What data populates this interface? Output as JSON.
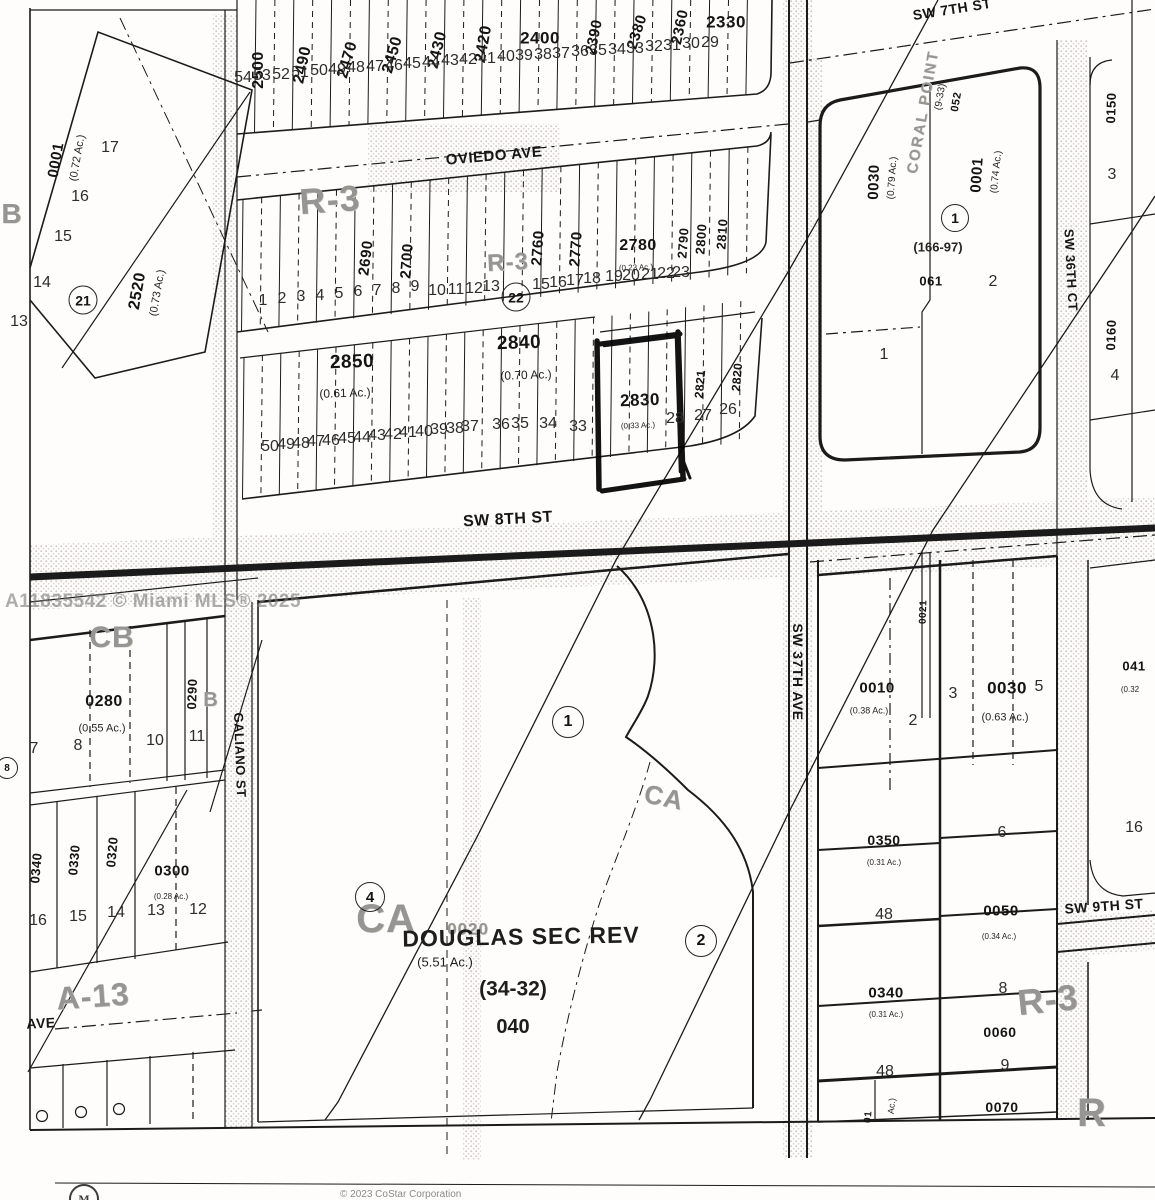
{
  "watermark": "A11835542 © Miami MLS® 2025",
  "footer": {
    "copyright": "© 2023 CoStar Corporation",
    "logo_letter": "M"
  },
  "colors": {
    "ink": "#1b1b1b",
    "zone_gray": "#979592",
    "paper": "#fefdfb",
    "highlight_marker": "#000000"
  },
  "highlighted_parcel": "2830",
  "subdivision": {
    "name": "DOUGLAS SEC REV",
    "plat": "(34-32)",
    "parcel": "040",
    "acreage": "(5.51 Ac.)"
  },
  "labels": {
    "streets": [
      {
        "t": "OVIEDO AVE",
        "x": 494,
        "y": 156,
        "s": 15,
        "r": -5,
        "n": "street-oviedo-ave"
      },
      {
        "t": "SW 8TH ST",
        "x": 508,
        "y": 520,
        "s": 16,
        "r": -3,
        "n": "street-sw-8th-st"
      },
      {
        "t": "SW 7TH ST",
        "x": 952,
        "y": 9,
        "s": 14,
        "r": -9,
        "n": "street-sw-7th-st"
      },
      {
        "t": "SW 37TH AVE",
        "x": 798,
        "y": 672,
        "s": 14,
        "r": 90,
        "n": "street-sw-37th-ave"
      },
      {
        "t": "SW 36TH CT",
        "x": 1071,
        "y": 270,
        "s": 13,
        "r": 87,
        "n": "street-sw-36th-ct"
      },
      {
        "t": "GALIANO ST",
        "x": 240,
        "y": 755,
        "s": 13,
        "r": 88,
        "n": "street-galiano-st"
      },
      {
        "t": "SW 9TH ST",
        "x": 1104,
        "y": 906,
        "s": 14,
        "r": -4,
        "n": "street-sw-9th-st"
      },
      {
        "t": "AVE",
        "x": 41,
        "y": 1023,
        "s": 14,
        "r": -3,
        "n": "street-ave"
      }
    ],
    "zones": [
      {
        "t": "R-3",
        "x": 330,
        "y": 200,
        "s": 36,
        "r": -4
      },
      {
        "t": "R-3",
        "x": 508,
        "y": 263,
        "s": 24,
        "r": -3
      },
      {
        "t": "B",
        "x": 12,
        "y": 214,
        "s": 28,
        "r": 0
      },
      {
        "t": "CB",
        "x": 112,
        "y": 638,
        "s": 30,
        "r": 0
      },
      {
        "t": "B",
        "x": 211,
        "y": 700,
        "s": 20,
        "r": 0
      },
      {
        "t": "A-13",
        "x": 93,
        "y": 996,
        "s": 32,
        "r": -4
      },
      {
        "t": "CA",
        "x": 664,
        "y": 797,
        "s": 26,
        "r": 12
      },
      {
        "t": "CA",
        "x": 386,
        "y": 919,
        "s": 40,
        "r": 0
      },
      {
        "t": "0020",
        "x": 468,
        "y": 929,
        "s": 17,
        "r": 0
      },
      {
        "t": "R-3",
        "x": 1048,
        "y": 1000,
        "s": 36,
        "r": -6
      },
      {
        "t": "R",
        "x": 1092,
        "y": 1113,
        "s": 40,
        "r": 0
      },
      {
        "t": "CORAL POINT",
        "x": 923,
        "y": 112,
        "s": 15,
        "r": -80,
        "ls": 2
      }
    ],
    "parcels": [
      {
        "t": "2500",
        "x": 259,
        "y": 70,
        "s": 16,
        "r": -90
      },
      {
        "t": "2490",
        "x": 303,
        "y": 65,
        "s": 16,
        "r": -78
      },
      {
        "t": "2470",
        "x": 348,
        "y": 60,
        "s": 16,
        "r": -74
      },
      {
        "t": "2450",
        "x": 393,
        "y": 55,
        "s": 16,
        "r": -74
      },
      {
        "t": "2430",
        "x": 438,
        "y": 50,
        "s": 16,
        "r": -76
      },
      {
        "t": "2420",
        "x": 484,
        "y": 44,
        "s": 16,
        "r": -80
      },
      {
        "t": "2400",
        "x": 540,
        "y": 38,
        "s": 17,
        "r": 0
      },
      {
        "t": "2390",
        "x": 594,
        "y": 37,
        "s": 15,
        "r": -78
      },
      {
        "t": "2380",
        "x": 637,
        "y": 32,
        "s": 15,
        "r": -72
      },
      {
        "t": "2360",
        "x": 680,
        "y": 27,
        "s": 15,
        "r": -78
      },
      {
        "t": "2330",
        "x": 726,
        "y": 22,
        "s": 17,
        "r": 0
      },
      {
        "t": "2690",
        "x": 366,
        "y": 258,
        "s": 15,
        "r": -83
      },
      {
        "t": "2700",
        "x": 407,
        "y": 261,
        "s": 15,
        "r": -86
      },
      {
        "t": "2760",
        "x": 538,
        "y": 248,
        "s": 15,
        "r": -86
      },
      {
        "t": "2770",
        "x": 576,
        "y": 249,
        "s": 15,
        "r": -86
      },
      {
        "t": "2780",
        "x": 638,
        "y": 246,
        "s": 16,
        "r": 0
      },
      {
        "t": "2790",
        "x": 683,
        "y": 243,
        "s": 13,
        "r": -86
      },
      {
        "t": "2800",
        "x": 701,
        "y": 239,
        "s": 13,
        "r": -86
      },
      {
        "t": "2810",
        "x": 722,
        "y": 234,
        "s": 13,
        "r": -86
      },
      {
        "t": "2850",
        "x": 352,
        "y": 362,
        "s": 19,
        "r": -2
      },
      {
        "t": "2840",
        "x": 519,
        "y": 343,
        "s": 19,
        "r": -2
      },
      {
        "t": "2830",
        "x": 640,
        "y": 400,
        "s": 17,
        "r": -2,
        "n": "parcel-number-2830-highlighted"
      },
      {
        "t": "2821",
        "x": 700,
        "y": 384,
        "s": 12,
        "r": -85
      },
      {
        "t": "2820",
        "x": 737,
        "y": 377,
        "s": 12,
        "r": -85
      },
      {
        "t": "2520",
        "x": 138,
        "y": 291,
        "s": 16,
        "r": -80
      },
      {
        "t": "0001",
        "x": 56,
        "y": 160,
        "s": 15,
        "r": -80
      },
      {
        "t": "0030",
        "x": 874,
        "y": 182,
        "s": 15,
        "r": -88
      },
      {
        "t": "052",
        "x": 957,
        "y": 102,
        "s": 11,
        "r": -80
      },
      {
        "t": "061",
        "x": 931,
        "y": 281,
        "s": 13,
        "r": 0
      },
      {
        "t": "0001",
        "x": 977,
        "y": 175,
        "s": 15,
        "r": -86
      },
      {
        "t": "0150",
        "x": 1111,
        "y": 108,
        "s": 13,
        "r": -88
      },
      {
        "t": "0160",
        "x": 1111,
        "y": 335,
        "s": 13,
        "r": -88
      },
      {
        "t": "0010",
        "x": 877,
        "y": 688,
        "s": 15,
        "r": 0
      },
      {
        "t": "0021",
        "x": 924,
        "y": 612,
        "s": 10,
        "r": -88
      },
      {
        "t": "0030",
        "x": 1007,
        "y": 688,
        "s": 17,
        "r": 0
      },
      {
        "t": "041",
        "x": 1134,
        "y": 666,
        "s": 13,
        "r": 0
      },
      {
        "t": "0350",
        "x": 884,
        "y": 840,
        "s": 14,
        "r": 0
      },
      {
        "t": "0050",
        "x": 1001,
        "y": 911,
        "s": 15,
        "r": 0
      },
      {
        "t": "0340",
        "x": 886,
        "y": 993,
        "s": 15,
        "r": 0
      },
      {
        "t": "0060",
        "x": 1000,
        "y": 1032,
        "s": 14,
        "r": 0
      },
      {
        "t": "0070",
        "x": 1002,
        "y": 1107,
        "s": 14,
        "r": 0
      },
      {
        "t": "0280",
        "x": 104,
        "y": 702,
        "s": 16,
        "r": 0
      },
      {
        "t": "0290",
        "x": 192,
        "y": 694,
        "s": 13,
        "r": -88
      },
      {
        "t": "0300",
        "x": 172,
        "y": 871,
        "s": 15,
        "r": 0
      },
      {
        "t": "0340",
        "x": 36,
        "y": 868,
        "s": 13,
        "r": -85
      },
      {
        "t": "0330",
        "x": 74,
        "y": 860,
        "s": 13,
        "r": -85
      },
      {
        "t": "0320",
        "x": 112,
        "y": 852,
        "s": 13,
        "r": -85
      },
      {
        "t": "01",
        "x": 869,
        "y": 1117,
        "s": 10,
        "r": -85
      }
    ],
    "acreages": [
      {
        "t": "(0.72 Ac.)",
        "x": 78,
        "y": 158,
        "s": 11,
        "r": -80
      },
      {
        "t": "(0.73 Ac.)",
        "x": 158,
        "y": 293,
        "s": 11,
        "r": -80
      },
      {
        "t": "(0.79 Ac.)",
        "x": 893,
        "y": 178,
        "s": 10,
        "r": -86
      },
      {
        "t": "(9-33)",
        "x": 941,
        "y": 97,
        "s": 10,
        "r": -80
      },
      {
        "t": "(0.74 Ac.)",
        "x": 997,
        "y": 172,
        "s": 10,
        "r": -84
      },
      {
        "t": "(166-97)",
        "x": 938,
        "y": 247,
        "s": 13,
        "r": 0,
        "w": 700
      },
      {
        "t": "(0.61 Ac.)",
        "x": 345,
        "y": 393,
        "s": 12,
        "r": -2
      },
      {
        "t": "(0.70 Ac.)",
        "x": 526,
        "y": 375,
        "s": 12,
        "r": -2
      },
      {
        "t": "(0.23 Ac.)",
        "x": 636,
        "y": 268,
        "s": 8,
        "r": -2
      },
      {
        "t": "(0.33 Ac.)",
        "x": 638,
        "y": 426,
        "s": 8,
        "r": -2
      },
      {
        "t": "(0.55 Ac.)",
        "x": 102,
        "y": 729,
        "s": 11,
        "r": 0
      },
      {
        "t": "(0.28 Ac.)",
        "x": 171,
        "y": 897,
        "s": 8,
        "r": 0
      },
      {
        "t": "(0.38 Ac.)",
        "x": 869,
        "y": 711,
        "s": 9,
        "r": 0
      },
      {
        "t": "(0.63 Ac.)",
        "x": 1005,
        "y": 718,
        "s": 11,
        "r": 0
      },
      {
        "t": "(0.32",
        "x": 1130,
        "y": 690,
        "s": 8,
        "r": 0
      },
      {
        "t": "(0.31 Ac.)",
        "x": 884,
        "y": 863,
        "s": 8,
        "r": 0
      },
      {
        "t": "(0.34 Ac.)",
        "x": 999,
        "y": 937,
        "s": 8,
        "r": 0
      },
      {
        "t": "(0.31 Ac.)",
        "x": 886,
        "y": 1015,
        "s": 8,
        "r": 0
      },
      {
        "t": "Ac.)",
        "x": 892,
        "y": 1106,
        "s": 9,
        "r": -85
      }
    ],
    "misc": [
      {
        "t": "DOUGLAS SEC REV",
        "x": 521,
        "y": 937,
        "s": 23,
        "r": -1,
        "w": 700,
        "ls": 1,
        "n": "subdivision-name"
      },
      {
        "t": "(5.51 Ac.)",
        "x": 445,
        "y": 962,
        "s": 13,
        "r": 0,
        "n": "subdivision-acreage"
      },
      {
        "t": "(34-32)",
        "x": 513,
        "y": 989,
        "s": 21,
        "r": 0,
        "w": 700,
        "n": "subdivision-plat"
      },
      {
        "t": "040",
        "x": 513,
        "y": 1027,
        "s": 20,
        "r": 0,
        "w": 700,
        "n": "subdivision-parcel"
      }
    ],
    "lots": [
      {
        "t": "54",
        "x": 243,
        "y": 78
      },
      {
        "t": "53",
        "x": 262,
        "y": 76
      },
      {
        "t": "52",
        "x": 281,
        "y": 75
      },
      {
        "t": "51",
        "x": 300,
        "y": 73
      },
      {
        "t": "50",
        "x": 319,
        "y": 71
      },
      {
        "t": "49",
        "x": 337,
        "y": 70
      },
      {
        "t": "48",
        "x": 356,
        "y": 68
      },
      {
        "t": "47",
        "x": 375,
        "y": 67
      },
      {
        "t": "46",
        "x": 394,
        "y": 66
      },
      {
        "t": "45",
        "x": 412,
        "y": 64
      },
      {
        "t": "44",
        "x": 431,
        "y": 63
      },
      {
        "t": "43",
        "x": 450,
        "y": 61
      },
      {
        "t": "42",
        "x": 468,
        "y": 60
      },
      {
        "t": "41",
        "x": 487,
        "y": 59
      },
      {
        "t": "40",
        "x": 506,
        "y": 57
      },
      {
        "t": "39",
        "x": 524,
        "y": 56
      },
      {
        "t": "38",
        "x": 543,
        "y": 55
      },
      {
        "t": "37",
        "x": 561,
        "y": 54
      },
      {
        "t": "36",
        "x": 580,
        "y": 52
      },
      {
        "t": "35",
        "x": 598,
        "y": 51
      },
      {
        "t": "34",
        "x": 617,
        "y": 50
      },
      {
        "t": "33",
        "x": 635,
        "y": 49
      },
      {
        "t": "32",
        "x": 654,
        "y": 47
      },
      {
        "t": "31",
        "x": 672,
        "y": 46
      },
      {
        "t": "30",
        "x": 691,
        "y": 44
      },
      {
        "t": "29",
        "x": 710,
        "y": 43
      },
      {
        "t": "1",
        "x": 263,
        "y": 301
      },
      {
        "t": "2",
        "x": 282,
        "y": 299
      },
      {
        "t": "3",
        "x": 301,
        "y": 297
      },
      {
        "t": "4",
        "x": 320,
        "y": 296
      },
      {
        "t": "5",
        "x": 339,
        "y": 294
      },
      {
        "t": "6",
        "x": 358,
        "y": 292
      },
      {
        "t": "7",
        "x": 377,
        "y": 291
      },
      {
        "t": "8",
        "x": 396,
        "y": 289
      },
      {
        "t": "9",
        "x": 415,
        "y": 287
      },
      {
        "t": "10",
        "x": 437,
        "y": 291
      },
      {
        "t": "11",
        "x": 456,
        "y": 290
      },
      {
        "t": "12",
        "x": 474,
        "y": 289
      },
      {
        "t": "13",
        "x": 491,
        "y": 287
      },
      {
        "t": "15",
        "x": 541,
        "y": 285
      },
      {
        "t": "16",
        "x": 558,
        "y": 283
      },
      {
        "t": "17",
        "x": 575,
        "y": 281
      },
      {
        "t": "18",
        "x": 592,
        "y": 279
      },
      {
        "t": "19",
        "x": 614,
        "y": 277
      },
      {
        "t": "20",
        "x": 631,
        "y": 276
      },
      {
        "t": "21",
        "x": 650,
        "y": 275
      },
      {
        "t": "22",
        "x": 666,
        "y": 274
      },
      {
        "t": "23",
        "x": 681,
        "y": 273
      },
      {
        "t": "50",
        "x": 270,
        "y": 447
      },
      {
        "t": "49",
        "x": 286,
        "y": 445
      },
      {
        "t": "48",
        "x": 301,
        "y": 444
      },
      {
        "t": "47",
        "x": 316,
        "y": 442
      },
      {
        "t": "46",
        "x": 331,
        "y": 441
      },
      {
        "t": "45",
        "x": 347,
        "y": 439
      },
      {
        "t": "44",
        "x": 362,
        "y": 438
      },
      {
        "t": "43",
        "x": 377,
        "y": 436
      },
      {
        "t": "42",
        "x": 393,
        "y": 435
      },
      {
        "t": "41",
        "x": 408,
        "y": 433
      },
      {
        "t": "40",
        "x": 424,
        "y": 432
      },
      {
        "t": "39",
        "x": 439,
        "y": 430
      },
      {
        "t": "38",
        "x": 455,
        "y": 429
      },
      {
        "t": "37",
        "x": 470,
        "y": 427
      },
      {
        "t": "36",
        "x": 501,
        "y": 425
      },
      {
        "t": "35",
        "x": 520,
        "y": 424
      },
      {
        "t": "34",
        "x": 548,
        "y": 424
      },
      {
        "t": "33",
        "x": 578,
        "y": 427
      },
      {
        "t": "28",
        "x": 675,
        "y": 419
      },
      {
        "t": "27",
        "x": 703,
        "y": 416
      },
      {
        "t": "26",
        "x": 728,
        "y": 410
      },
      {
        "t": "17",
        "x": 110,
        "y": 148
      },
      {
        "t": "16",
        "x": 80,
        "y": 197
      },
      {
        "t": "15",
        "x": 63,
        "y": 237
      },
      {
        "t": "14",
        "x": 42,
        "y": 283
      },
      {
        "t": "13",
        "x": 19,
        "y": 322
      },
      {
        "t": "1",
        "x": 884,
        "y": 355
      },
      {
        "t": "2",
        "x": 993,
        "y": 282
      },
      {
        "t": "3",
        "x": 1112,
        "y": 175
      },
      {
        "t": "4",
        "x": 1115,
        "y": 376
      },
      {
        "t": "2",
        "x": 913,
        "y": 721
      },
      {
        "t": "3",
        "x": 953,
        "y": 694
      },
      {
        "t": "5",
        "x": 1039,
        "y": 687
      },
      {
        "t": "6",
        "x": 1002,
        "y": 833
      },
      {
        "t": "48",
        "x": 884,
        "y": 915
      },
      {
        "t": "8",
        "x": 1003,
        "y": 989
      },
      {
        "t": "9",
        "x": 1005,
        "y": 1066
      },
      {
        "t": "48",
        "x": 885,
        "y": 1072
      },
      {
        "t": "16",
        "x": 1134,
        "y": 828
      },
      {
        "t": "7",
        "x": 34,
        "y": 749
      },
      {
        "t": "8",
        "x": 78,
        "y": 746
      },
      {
        "t": "10",
        "x": 155,
        "y": 741
      },
      {
        "t": "11",
        "x": 197,
        "y": 737
      },
      {
        "t": "16",
        "x": 38,
        "y": 921
      },
      {
        "t": "15",
        "x": 78,
        "y": 917
      },
      {
        "t": "14",
        "x": 116,
        "y": 913
      },
      {
        "t": "13",
        "x": 156,
        "y": 911
      },
      {
        "t": "12",
        "x": 198,
        "y": 910
      }
    ],
    "circled": [
      {
        "t": "21",
        "x": 83,
        "y": 300,
        "d": 27
      },
      {
        "t": "22",
        "x": 516,
        "y": 297,
        "d": 27
      },
      {
        "t": "1",
        "x": 955,
        "y": 218,
        "d": 26
      },
      {
        "t": "1",
        "x": 568,
        "y": 722,
        "d": 30
      },
      {
        "t": "4",
        "x": 370,
        "y": 897,
        "d": 28
      },
      {
        "t": "2",
        "x": 701,
        "y": 941,
        "d": 30
      },
      {
        "t": "8",
        "x": 7,
        "y": 768,
        "d": 20
      }
    ]
  }
}
